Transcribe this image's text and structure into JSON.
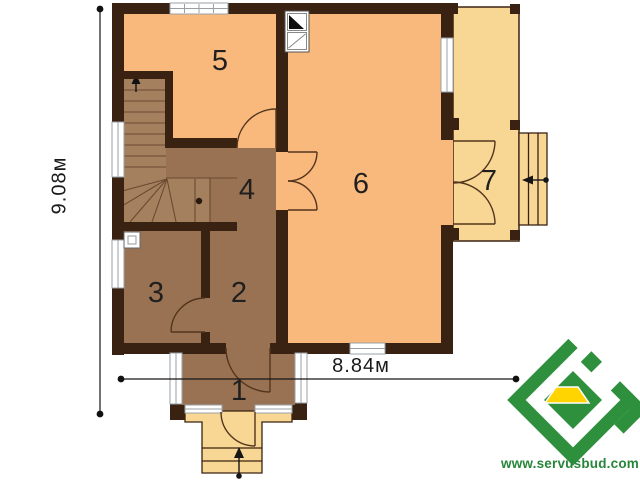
{
  "plan": {
    "rooms": [
      {
        "id": "vestibule",
        "label": "1"
      },
      {
        "id": "hallway",
        "label": "2"
      },
      {
        "id": "room-3",
        "label": "3"
      },
      {
        "id": "hall-stairs",
        "label": "4"
      },
      {
        "id": "room-5",
        "label": "5"
      },
      {
        "id": "living-room",
        "label": "6"
      },
      {
        "id": "terrace",
        "label": "7"
      }
    ],
    "dimensions": {
      "vertical": "9.08м",
      "horizontal": "8.84м"
    },
    "branding": {
      "website": "www.servusbud.com",
      "logo_green": "#2e8f3c",
      "logo_yellow": "#ffd400"
    },
    "colors": {
      "living_peach": "#f9b87c",
      "room_brown": "#997253",
      "stair_brown": "#a5805f",
      "terrace_yellow": "#f8d795",
      "wall_dark": "#3a2212"
    },
    "symbols": {
      "stair_direction": "up-arrow",
      "main_entry": "up-arrow",
      "side_entry": "left-arrow",
      "chimney": "flue-and-vent-box",
      "vent": "vent-box"
    }
  }
}
